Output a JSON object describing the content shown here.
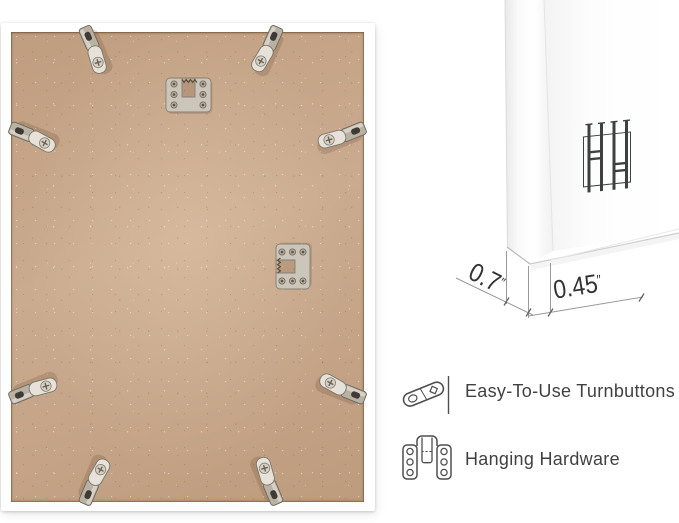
{
  "canvas": {
    "width": 679,
    "height": 523
  },
  "product_scene": {
    "left_panel": "back of picture frame with mounting hardware",
    "right_panel": "frame corner profile with dimensions and feature legend"
  },
  "dimensions": {
    "depth": {
      "value": "0.7",
      "unit": "″"
    },
    "face": {
      "value": "0.45",
      "unit": "″"
    }
  },
  "features": [
    {
      "icon": "turnbutton-icon",
      "label": "Easy-To-Use Turnbuttons"
    },
    {
      "icon": "hanging-hardware-icon",
      "label": "Hanging Hardware"
    }
  ],
  "icons": {
    "corner_overlay": "hanging-hardware-3d-icon"
  },
  "colors": {
    "background": "#ffffff",
    "frame_white": "#ffffff",
    "mdf_board": "#c7a587",
    "hardware_metal": "#d9d4c9",
    "dimension_line": "#9a9a9a",
    "dimension_text": "#333333",
    "label_text": "#414141",
    "icon_stroke": "#4e4f51"
  }
}
